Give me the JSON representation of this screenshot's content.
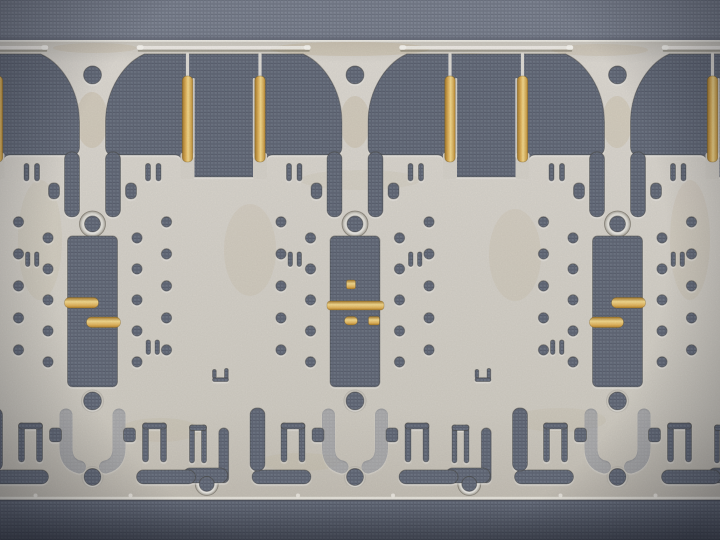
{
  "scene": {
    "subject": "stamped-metal-lead-frame-strip-on-gray-fabric",
    "description": "macro photo of a progressive-die stamped lead frame with gold plated contact pads",
    "colors": {
      "fabric_base": "#7e8492",
      "fabric_line_h": "#6e7482",
      "fabric_line_v": "#747a88",
      "fabric_knot": "#8b91a0",
      "fabric_dark_base": "#6b7280",
      "fabric_dark_line_h": "#5c6271",
      "fabric_dark_line_v": "#626877",
      "fabric_dark_knot": "#777d8c",
      "metal_top": "#cbc7bf",
      "metal_hi": "#dedad3",
      "metal_mid": "#d7d3cb",
      "metal_low": "#c5c0b6",
      "metal_edge_dark": "#44413c",
      "metal_edge_light": "#f0ede7",
      "metal_sliver": "#e6e3db",
      "stain": "#bfae8d",
      "ring_hi": "#f4f3f0",
      "ring_lo": "#a5a198",
      "gold_dark": "#a87c2e",
      "gold_mid": "#e2b55e",
      "gold_light": "#f4da90",
      "gold_edge": "#7a5a18",
      "seam_dark": "#3f434d",
      "vignette": "#0f121c",
      "bottom_shade": "#0a0c14"
    },
    "geometry": {
      "width": 720,
      "height": 540,
      "plate_top": 40,
      "plate_bottom": 500,
      "cell_period": 262.5,
      "rail_tab_half_len": 84,
      "gold_tab_offset": 95,
      "outer_hole_col_x": 74,
      "inner_hole_col_x": 44.5,
      "outer_hole_rows": [
        222,
        254,
        286,
        318,
        350
      ],
      "inner_hole_rows": [
        238,
        269,
        300,
        331,
        362
      ],
      "hole_radius": 5.2,
      "trunk_hole": {
        "y": 75,
        "r": 9
      },
      "ring_hole": {
        "y": 224,
        "r": 8,
        "ring_r": 13
      },
      "pad_window": {
        "x": -25,
        "y": 236,
        "w": 50,
        "h": 151
      },
      "bottom_hole_upper": {
        "y": 401,
        "r": 9
      },
      "bottom_hole_lower": {
        "y": 477,
        "r": 8.5
      },
      "boundary_ring_hole": {
        "dx": -17,
        "y": 484,
        "r": 7.5,
        "ring_r": 11.5
      }
    },
    "cells": [
      {
        "center": 92.5,
        "gold_variant": "left",
        "body_ticks": [
          "upper-left",
          "lower-right"
        ]
      },
      {
        "center": 355,
        "gold_variant": "full",
        "body_ticks": [
          "upper-left",
          "upper-right"
        ]
      },
      {
        "center": 617.5,
        "gold_variant": "right",
        "body_ticks": [
          "upper-right",
          "lower-left"
        ]
      }
    ]
  }
}
